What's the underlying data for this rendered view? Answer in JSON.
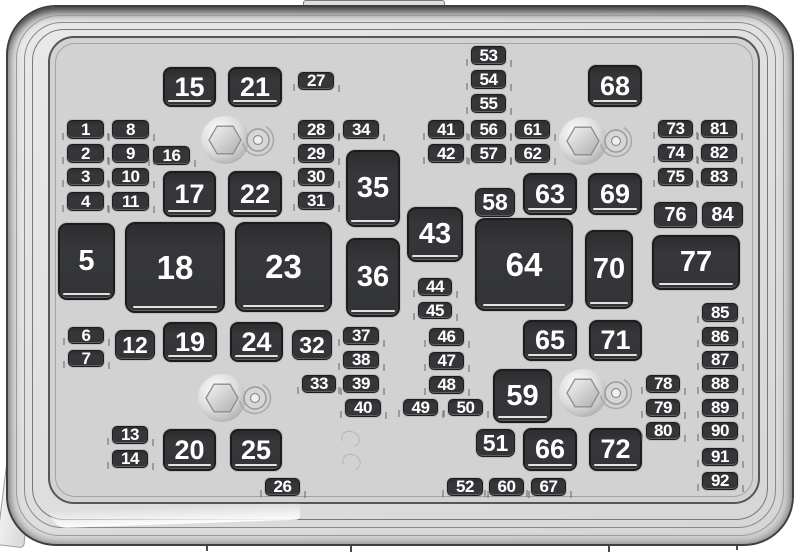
{
  "diagram": {
    "kind": "fuse-box-layout",
    "colors": {
      "case_fill": "#e0e0e0",
      "tray_fill": "#d2d2d2",
      "fuse_fill": "#36373a",
      "fuse_text": "#ffffff"
    },
    "fuses": [
      {
        "label": "1",
        "x": 67,
        "y": 120,
        "w": 37,
        "h": 19,
        "size": "s"
      },
      {
        "label": "2",
        "x": 67,
        "y": 144,
        "w": 37,
        "h": 19,
        "size": "s"
      },
      {
        "label": "3",
        "x": 67,
        "y": 168,
        "w": 37,
        "h": 18,
        "size": "s"
      },
      {
        "label": "4",
        "x": 67,
        "y": 192,
        "w": 37,
        "h": 19,
        "size": "s"
      },
      {
        "label": "5",
        "x": 58,
        "y": 223,
        "w": 57,
        "h": 77,
        "size": "l"
      },
      {
        "label": "6",
        "x": 68,
        "y": 327,
        "w": 36,
        "h": 17,
        "size": "s"
      },
      {
        "label": "7",
        "x": 68,
        "y": 350,
        "w": 36,
        "h": 17,
        "size": "s"
      },
      {
        "label": "8",
        "x": 112,
        "y": 120,
        "w": 37,
        "h": 19,
        "size": "s"
      },
      {
        "label": "9",
        "x": 112,
        "y": 144,
        "w": 37,
        "h": 19,
        "size": "s"
      },
      {
        "label": "10",
        "x": 112,
        "y": 168,
        "w": 37,
        "h": 18,
        "size": "s"
      },
      {
        "label": "11",
        "x": 112,
        "y": 192,
        "w": 37,
        "h": 19,
        "size": "s"
      },
      {
        "label": "12",
        "x": 115,
        "y": 330,
        "w": 40,
        "h": 30,
        "size": "m2"
      },
      {
        "label": "13",
        "x": 112,
        "y": 426,
        "w": 36,
        "h": 18,
        "size": "s"
      },
      {
        "label": "14",
        "x": 112,
        "y": 450,
        "w": 36,
        "h": 18,
        "size": "s"
      },
      {
        "label": "15",
        "x": 163,
        "y": 67,
        "w": 53,
        "h": 40,
        "size": "r"
      },
      {
        "label": "16",
        "x": 153,
        "y": 146,
        "w": 37,
        "h": 19,
        "size": "s"
      },
      {
        "label": "17",
        "x": 163,
        "y": 171,
        "w": 53,
        "h": 46,
        "size": "r"
      },
      {
        "label": "18",
        "x": 125,
        "y": 222,
        "w": 100,
        "h": 91,
        "size": "xl"
      },
      {
        "label": "19",
        "x": 163,
        "y": 322,
        "w": 54,
        "h": 40,
        "size": "r"
      },
      {
        "label": "20",
        "x": 163,
        "y": 429,
        "w": 53,
        "h": 42,
        "size": "r"
      },
      {
        "label": "21",
        "x": 228,
        "y": 67,
        "w": 54,
        "h": 40,
        "size": "r"
      },
      {
        "label": "22",
        "x": 228,
        "y": 171,
        "w": 54,
        "h": 46,
        "size": "r"
      },
      {
        "label": "23",
        "x": 235,
        "y": 222,
        "w": 97,
        "h": 90,
        "size": "xl"
      },
      {
        "label": "24",
        "x": 230,
        "y": 322,
        "w": 53,
        "h": 40,
        "size": "r"
      },
      {
        "label": "25",
        "x": 230,
        "y": 429,
        "w": 52,
        "h": 42,
        "size": "r"
      },
      {
        "label": "26",
        "x": 265,
        "y": 478,
        "w": 35,
        "h": 18,
        "size": "s"
      },
      {
        "label": "27",
        "x": 298,
        "y": 72,
        "w": 36,
        "h": 18,
        "size": "s"
      },
      {
        "label": "28",
        "x": 298,
        "y": 120,
        "w": 36,
        "h": 19,
        "size": "s"
      },
      {
        "label": "29",
        "x": 298,
        "y": 144,
        "w": 36,
        "h": 19,
        "size": "s"
      },
      {
        "label": "30",
        "x": 298,
        "y": 168,
        "w": 36,
        "h": 18,
        "size": "s"
      },
      {
        "label": "31",
        "x": 298,
        "y": 192,
        "w": 36,
        "h": 18,
        "size": "s"
      },
      {
        "label": "32",
        "x": 292,
        "y": 330,
        "w": 40,
        "h": 30,
        "size": "m2"
      },
      {
        "label": "33",
        "x": 302,
        "y": 375,
        "w": 34,
        "h": 18,
        "size": "s"
      },
      {
        "label": "34",
        "x": 343,
        "y": 120,
        "w": 36,
        "h": 19,
        "size": "s"
      },
      {
        "label": "35",
        "x": 346,
        "y": 150,
        "w": 54,
        "h": 77,
        "size": "l"
      },
      {
        "label": "36",
        "x": 346,
        "y": 238,
        "w": 54,
        "h": 79,
        "size": "l"
      },
      {
        "label": "37",
        "x": 343,
        "y": 327,
        "w": 36,
        "h": 18,
        "size": "s"
      },
      {
        "label": "38",
        "x": 343,
        "y": 351,
        "w": 36,
        "h": 18,
        "size": "s"
      },
      {
        "label": "39",
        "x": 343,
        "y": 375,
        "w": 36,
        "h": 18,
        "size": "s"
      },
      {
        "label": "40",
        "x": 345,
        "y": 399,
        "w": 36,
        "h": 18,
        "size": "s"
      },
      {
        "label": "41",
        "x": 428,
        "y": 120,
        "w": 36,
        "h": 19,
        "size": "s"
      },
      {
        "label": "42",
        "x": 428,
        "y": 144,
        "w": 36,
        "h": 19,
        "size": "s"
      },
      {
        "label": "43",
        "x": 407,
        "y": 207,
        "w": 56,
        "h": 55,
        "size": "l"
      },
      {
        "label": "44",
        "x": 418,
        "y": 278,
        "w": 34,
        "h": 18,
        "size": "s"
      },
      {
        "label": "45",
        "x": 418,
        "y": 302,
        "w": 34,
        "h": 17,
        "size": "s"
      },
      {
        "label": "46",
        "x": 429,
        "y": 328,
        "w": 35,
        "h": 18,
        "size": "s"
      },
      {
        "label": "47",
        "x": 429,
        "y": 352,
        "w": 35,
        "h": 18,
        "size": "s"
      },
      {
        "label": "48",
        "x": 429,
        "y": 376,
        "w": 35,
        "h": 18,
        "size": "s"
      },
      {
        "label": "49",
        "x": 403,
        "y": 399,
        "w": 35,
        "h": 17,
        "size": "s"
      },
      {
        "label": "50",
        "x": 448,
        "y": 399,
        "w": 35,
        "h": 17,
        "size": "s"
      },
      {
        "label": "51",
        "x": 476,
        "y": 429,
        "w": 39,
        "h": 28,
        "size": "m2"
      },
      {
        "label": "52",
        "x": 447,
        "y": 478,
        "w": 36,
        "h": 18,
        "size": "s"
      },
      {
        "label": "53",
        "x": 471,
        "y": 46,
        "w": 35,
        "h": 19,
        "size": "s"
      },
      {
        "label": "54",
        "x": 471,
        "y": 70,
        "w": 35,
        "h": 19,
        "size": "s"
      },
      {
        "label": "55",
        "x": 471,
        "y": 94,
        "w": 35,
        "h": 19,
        "size": "s"
      },
      {
        "label": "56",
        "x": 471,
        "y": 120,
        "w": 35,
        "h": 19,
        "size": "s"
      },
      {
        "label": "57",
        "x": 471,
        "y": 144,
        "w": 35,
        "h": 19,
        "size": "s"
      },
      {
        "label": "58",
        "x": 475,
        "y": 188,
        "w": 40,
        "h": 29,
        "size": "m2"
      },
      {
        "label": "59",
        "x": 493,
        "y": 369,
        "w": 59,
        "h": 54,
        "size": "l"
      },
      {
        "label": "60",
        "x": 489,
        "y": 478,
        "w": 35,
        "h": 18,
        "size": "s"
      },
      {
        "label": "61",
        "x": 515,
        "y": 120,
        "w": 35,
        "h": 19,
        "size": "s"
      },
      {
        "label": "62",
        "x": 515,
        "y": 144,
        "w": 35,
        "h": 19,
        "size": "s"
      },
      {
        "label": "63",
        "x": 523,
        "y": 173,
        "w": 54,
        "h": 42,
        "size": "r"
      },
      {
        "label": "64",
        "x": 475,
        "y": 218,
        "w": 98,
        "h": 93,
        "size": "xl"
      },
      {
        "label": "65",
        "x": 523,
        "y": 320,
        "w": 54,
        "h": 41,
        "size": "r"
      },
      {
        "label": "66",
        "x": 523,
        "y": 428,
        "w": 54,
        "h": 43,
        "size": "r"
      },
      {
        "label": "67",
        "x": 531,
        "y": 478,
        "w": 35,
        "h": 18,
        "size": "s"
      },
      {
        "label": "68",
        "x": 588,
        "y": 65,
        "w": 54,
        "h": 42,
        "size": "r"
      },
      {
        "label": "69",
        "x": 588,
        "y": 173,
        "w": 54,
        "h": 42,
        "size": "r"
      },
      {
        "label": "70",
        "x": 585,
        "y": 230,
        "w": 48,
        "h": 79,
        "size": "l"
      },
      {
        "label": "71",
        "x": 589,
        "y": 320,
        "w": 53,
        "h": 41,
        "size": "r"
      },
      {
        "label": "72",
        "x": 589,
        "y": 428,
        "w": 53,
        "h": 43,
        "size": "r"
      },
      {
        "label": "73",
        "x": 658,
        "y": 120,
        "w": 35,
        "h": 18,
        "size": "s"
      },
      {
        "label": "74",
        "x": 658,
        "y": 144,
        "w": 35,
        "h": 18,
        "size": "s"
      },
      {
        "label": "75",
        "x": 658,
        "y": 168,
        "w": 35,
        "h": 18,
        "size": "s"
      },
      {
        "label": "76",
        "x": 654,
        "y": 202,
        "w": 43,
        "h": 26,
        "size": "m1"
      },
      {
        "label": "77",
        "x": 652,
        "y": 235,
        "w": 88,
        "h": 55,
        "size": "l"
      },
      {
        "label": "78",
        "x": 646,
        "y": 375,
        "w": 34,
        "h": 18,
        "size": "s"
      },
      {
        "label": "79",
        "x": 646,
        "y": 399,
        "w": 34,
        "h": 18,
        "size": "s"
      },
      {
        "label": "80",
        "x": 646,
        "y": 422,
        "w": 34,
        "h": 18,
        "size": "s"
      },
      {
        "label": "81",
        "x": 701,
        "y": 120,
        "w": 36,
        "h": 18,
        "size": "s"
      },
      {
        "label": "82",
        "x": 701,
        "y": 144,
        "w": 36,
        "h": 18,
        "size": "s"
      },
      {
        "label": "83",
        "x": 701,
        "y": 168,
        "w": 36,
        "h": 18,
        "size": "s"
      },
      {
        "label": "84",
        "x": 702,
        "y": 202,
        "w": 41,
        "h": 26,
        "size": "m1"
      },
      {
        "label": "85",
        "x": 702,
        "y": 303,
        "w": 36,
        "h": 19,
        "size": "s"
      },
      {
        "label": "86",
        "x": 702,
        "y": 327,
        "w": 36,
        "h": 19,
        "size": "s"
      },
      {
        "label": "87",
        "x": 702,
        "y": 351,
        "w": 36,
        "h": 18,
        "size": "s"
      },
      {
        "label": "88",
        "x": 702,
        "y": 375,
        "w": 36,
        "h": 18,
        "size": "s"
      },
      {
        "label": "89",
        "x": 702,
        "y": 399,
        "w": 36,
        "h": 18,
        "size": "s"
      },
      {
        "label": "90",
        "x": 702,
        "y": 422,
        "w": 36,
        "h": 18,
        "size": "s"
      },
      {
        "label": "91",
        "x": 702,
        "y": 448,
        "w": 36,
        "h": 18,
        "size": "s"
      },
      {
        "label": "92",
        "x": 702,
        "y": 472,
        "w": 36,
        "h": 18,
        "size": "s"
      }
    ],
    "bolts": [
      {
        "cx": 225,
        "cy": 140
      },
      {
        "cx": 583,
        "cy": 141
      },
      {
        "cx": 222,
        "cy": 398
      },
      {
        "cx": 583,
        "cy": 393
      }
    ],
    "ghost_rings": [
      {
        "cx": 350,
        "cy": 439
      },
      {
        "cx": 351,
        "cy": 462
      }
    ],
    "edge_ticks": [
      {
        "x": 206,
        "y": 542
      },
      {
        "x": 350,
        "y": 543
      },
      {
        "x": 608,
        "y": 544
      },
      {
        "x": 736,
        "y": 541
      }
    ],
    "mount_tab": {
      "x": 303,
      "y": 0,
      "w": 140,
      "h": 13
    },
    "mount_flange": {
      "x": 2,
      "y": 450,
      "w": 26,
      "h": 95
    }
  }
}
